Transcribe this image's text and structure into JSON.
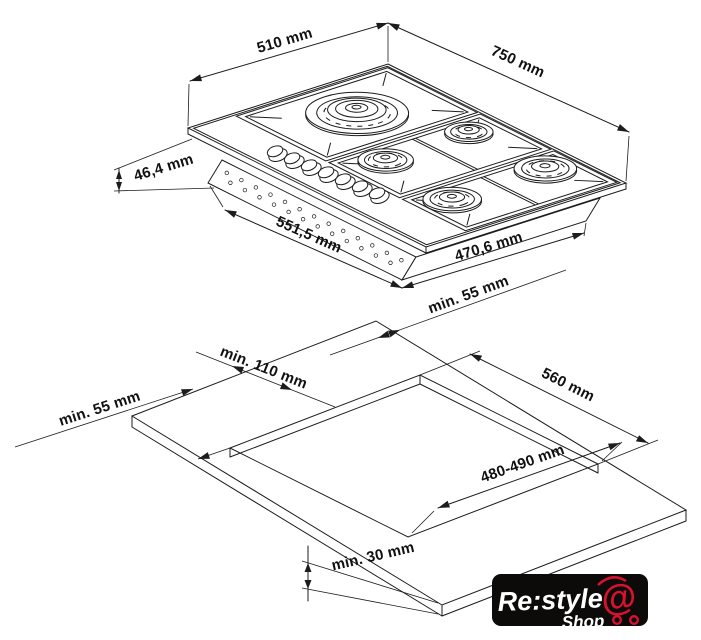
{
  "product_diagram": {
    "hob_view": {
      "width_label": "510 mm",
      "depth_label": "750 mm",
      "height_label": "46,4 mm",
      "body_width_label": "551,5 mm",
      "body_depth_label": "470,6 mm",
      "burner_count": 5
    },
    "installation_view": {
      "back_clearance_label": "min. 55 mm",
      "cutout_width_label": "560 mm",
      "left_back_clearance_label": "min. 110 mm",
      "left_clearance_label": "min. 55 mm",
      "cutout_depth_label": "480-490 mm",
      "worktop_thickness_label": "min. 30 mm"
    },
    "line_color": "#1c1c1c",
    "background": "#ffffff"
  },
  "watermark": {
    "brand": "Re:style",
    "shop": "Shop",
    "at_symbol": "@",
    "background": "#0d0a0a",
    "accent_red": "#d8112e",
    "text_color": "#ffffff"
  }
}
